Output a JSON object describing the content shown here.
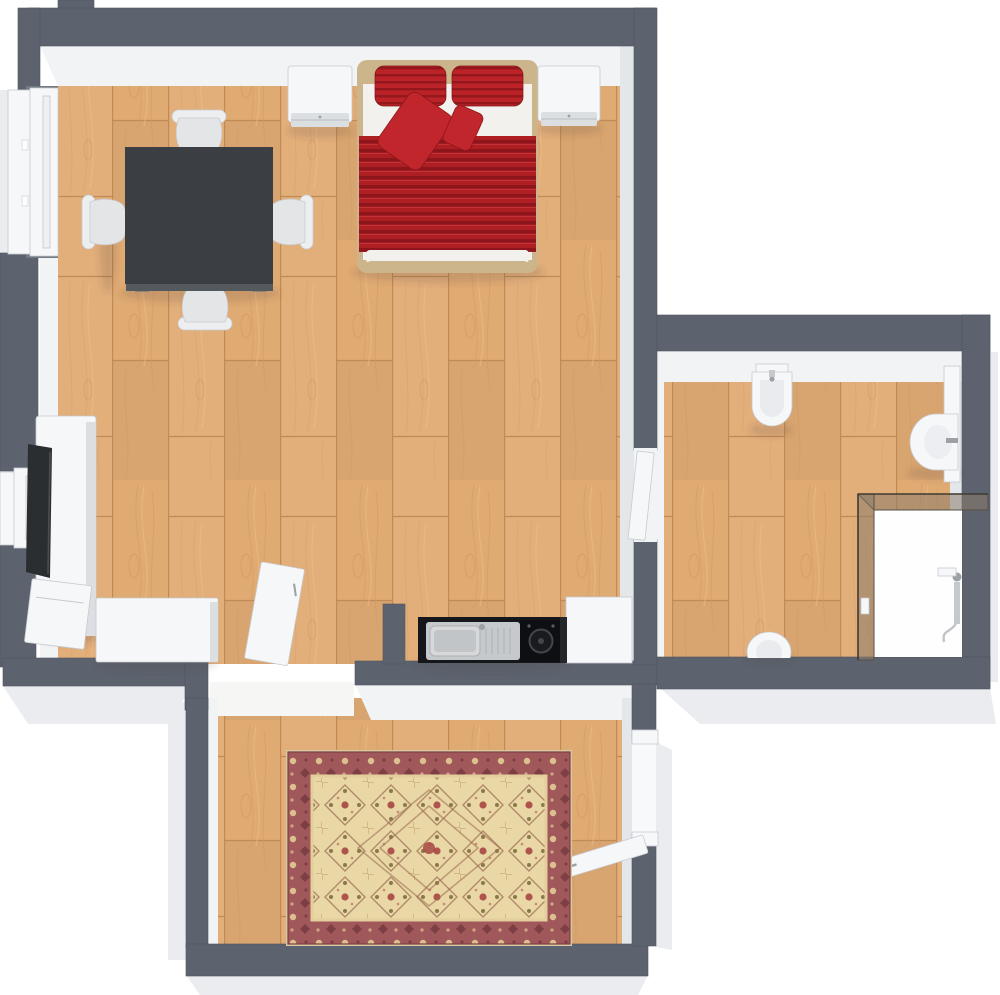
{
  "image": {
    "kind": "3d-floor-plan",
    "width": 1000,
    "height": 995,
    "visible_text": ""
  },
  "colors": {
    "wall": "#5c636e",
    "wallEdge": "#4e555f",
    "face": "#f2f3f5",
    "faceShade": "#e4e7ea",
    "outer": "#eaecef",
    "floorBase": "#e0aa73",
    "floorLine": "#c08a54",
    "floorGrain": "#cf9a63",
    "floorHi": "#eec28c",
    "duvet": "#ae1f24",
    "duvetStripe": "#8c161b",
    "pillow": "#bb2328",
    "pillowStripe": "#93181d",
    "accentPillow": "#c0262c",
    "bedFrame": "#cdb58b",
    "linen": "#f3f1ed",
    "table": "#3b3f43",
    "tableEdge": "#54595e",
    "tableLeg": "#8d8678",
    "chair": "#e3e5e7",
    "chairBack": "#edeef0",
    "chairLine": "#c9ccd0",
    "white": "#f6f7f8",
    "whiteShade": "#dcdfe2",
    "outline": "#c7cad0",
    "black": "#15171a",
    "steel": "#c6c9cc",
    "steelDark": "#9da1a5",
    "glass": "#8b7c6a",
    "rugBorder": "#a1585a",
    "rugBorderDark": "#7e3f44",
    "rugField": "#e9d7a6",
    "rugMotif": "#9a6a50",
    "rugAccent": "#a33d3c",
    "rugOlive": "#8a7a4a",
    "shadow": "#4a443e"
  },
  "plan": {
    "label": "3D apartment floor plan, top view"
  },
  "rooms": {
    "living": {
      "label": "Living and bedroom with double bed, dining table, TV sideboard and kitchenette"
    },
    "bathroom": {
      "label": "Bathroom with bidet, washbasin, shower enclosure and toilet"
    },
    "entry": {
      "label": "Entry room with oriental rug"
    }
  },
  "furniture": {
    "bed": {
      "label": "Double bed with red striped duvet and four red pillows"
    },
    "nightstand_left": {
      "label": "White nightstand left of bed"
    },
    "nightstand_right": {
      "label": "White nightstand right of bed"
    },
    "dining_table": {
      "label": "Square dark dining table"
    },
    "chair_top": {
      "label": "Chair, north side"
    },
    "chair_left": {
      "label": "Chair, west side"
    },
    "chair_right": {
      "label": "Chair, east side"
    },
    "chair_bottom": {
      "label": "Chair, south side"
    },
    "tv_unit": {
      "label": "White TV sideboard against left wall"
    },
    "tv": {
      "label": "Flat television on sideboard"
    },
    "side_unit": {
      "label": "Small white unit in corner"
    },
    "lowboard": {
      "label": "White cabinet on bottom wall"
    },
    "kitchen_counter": {
      "label": "Black kitchenette counter with stainless sink and cooktop"
    },
    "kitchen_cabinet": {
      "label": "White kitchen cabinet"
    },
    "rug": {
      "label": "Red and cream oriental rug"
    },
    "bidet": {
      "label": "Bidet on bathroom top wall"
    },
    "basin": {
      "label": "Wall-mounted washbasin with mirror panel"
    },
    "shower": {
      "label": "Corner shower with tinted glass"
    },
    "toilet": {
      "label": "Toilet at bathroom bottom wall"
    }
  },
  "openings": {
    "window_large": {
      "label": "Large window in left wall"
    },
    "window_small": {
      "label": "Small window in left wall"
    },
    "door_bathroom": {
      "label": "Open door between living room and bathroom"
    },
    "door_entry_room": {
      "label": "Open door between living room and entry room"
    },
    "door_main": {
      "label": "Open entry door in right wall of entry room"
    }
  }
}
